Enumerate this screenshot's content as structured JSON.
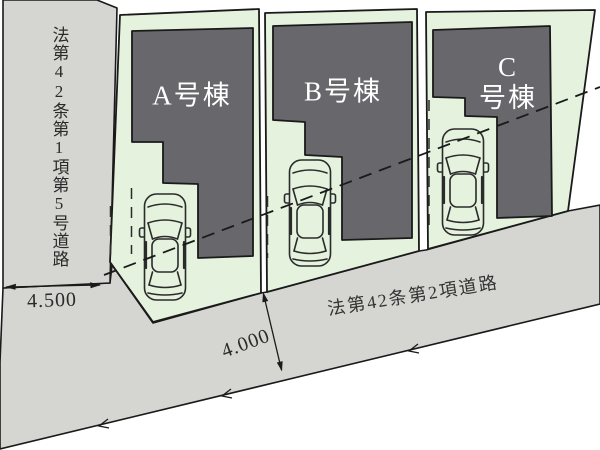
{
  "site_plan": {
    "roads": {
      "left": {
        "label": "法第42条第1項第5号道路",
        "width_label": "4.500"
      },
      "bottom": {
        "label": "法第42条第2項道路",
        "width_label": "4.000"
      }
    },
    "lots": [
      {
        "id": "A",
        "label": "A号棟",
        "display": "A号棟"
      },
      {
        "id": "B",
        "label": "B号棟",
        "display": "B号棟"
      },
      {
        "id": "C",
        "label": "C号棟",
        "display": "C\n号棟"
      }
    ],
    "dimensions": [
      {
        "value": "4.500",
        "measures": "left road width"
      },
      {
        "value": "4.000",
        "measures": "bottom road width"
      }
    ],
    "icons": [
      {
        "name": "car-icon",
        "meaning": "parked car, top view line art",
        "count": 3
      }
    ],
    "colors": {
      "road_fill": "#d5d5d2",
      "lot_fill": "#e4f2de",
      "building_fill": "#68676b",
      "line": "#1a1a1a",
      "lot_label_text": "#ffffff"
    }
  }
}
